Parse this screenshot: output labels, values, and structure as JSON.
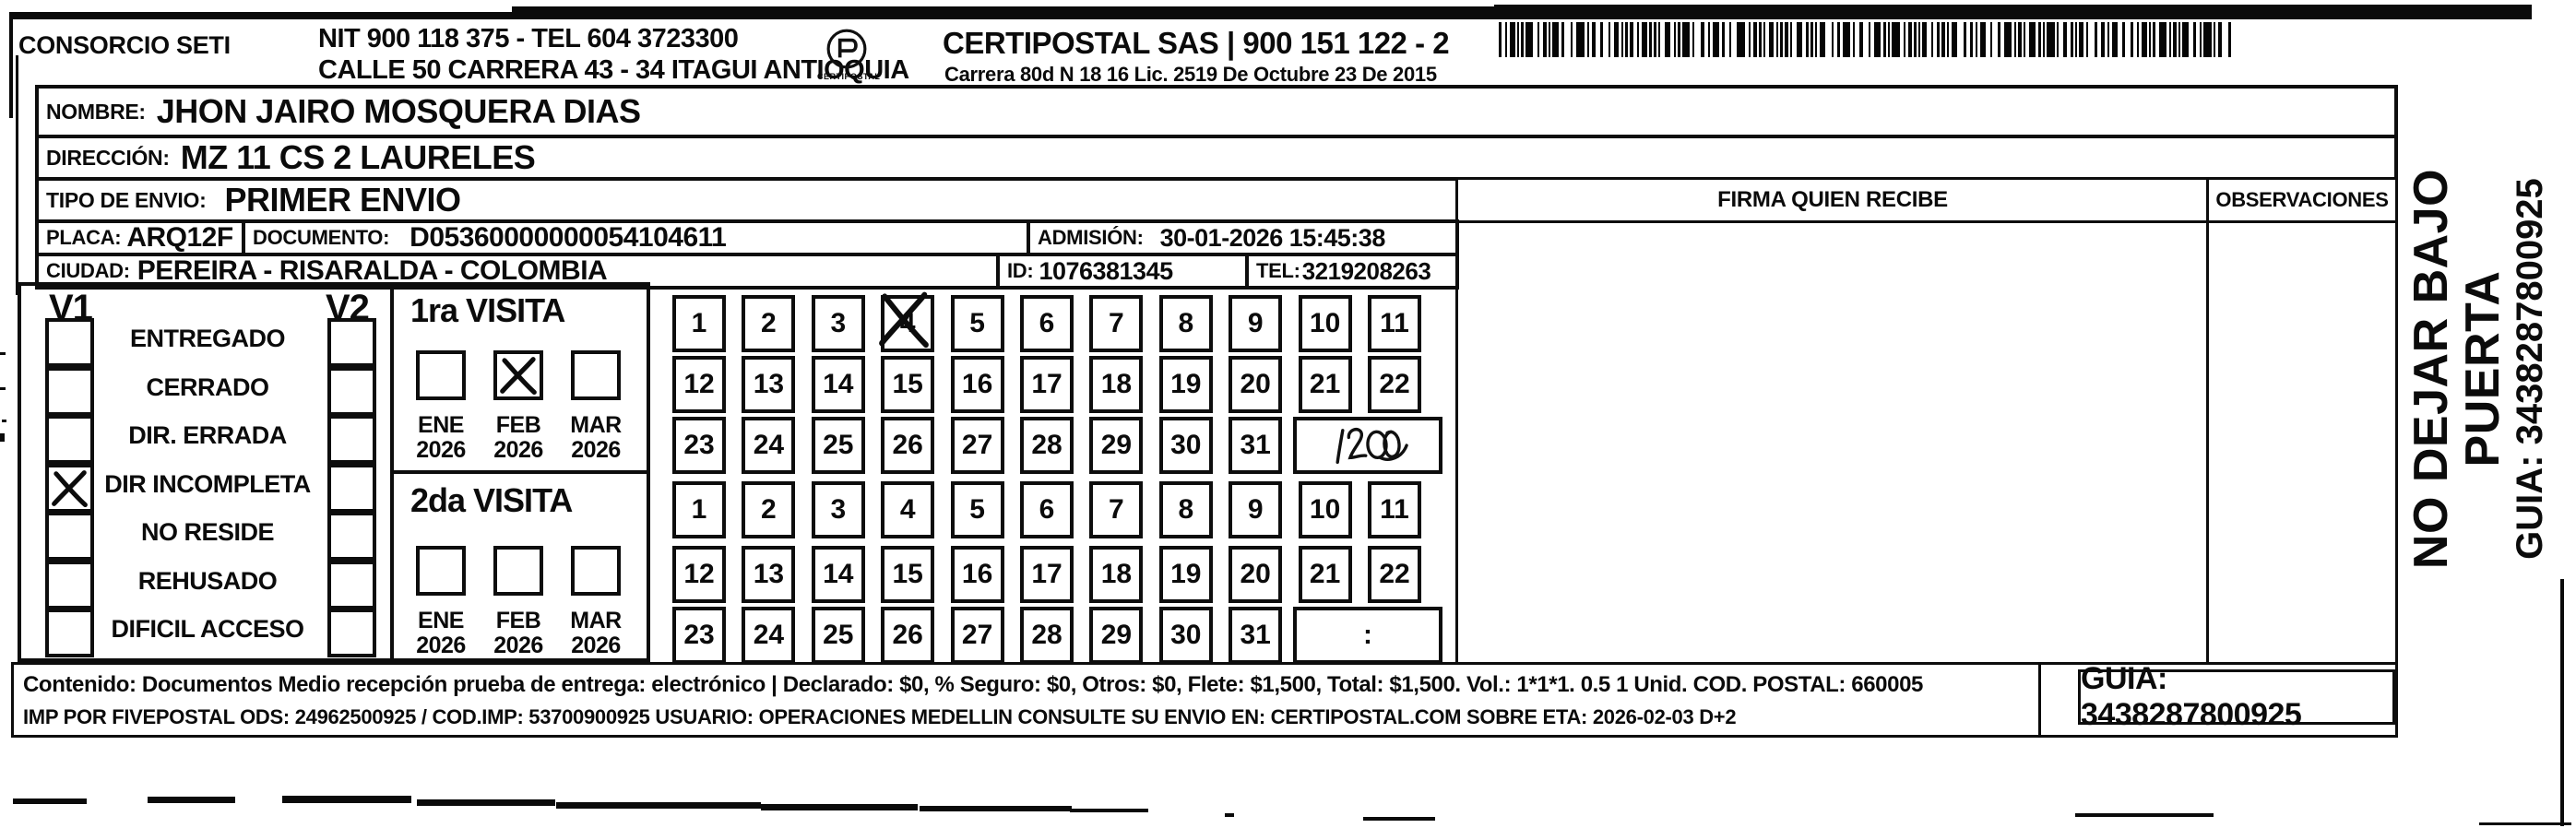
{
  "header": {
    "company": "CONSORCIO SETI",
    "nit_tel": "NIT 900 118 375 - TEL 604 3723300",
    "street": "CALLE 50 CARRERA 43 - 34 ITAGUI ANTIOQUIA",
    "logo_caption": "CERTIPOSTAL",
    "brand_line": "CERTIPOSTAL SAS | 900 151 122 - 2",
    "license_line": "Carrera 80d N 18 16  Lic. 2519 De Octubre 23 De 2015"
  },
  "shipment": {
    "nombre_label": "NOMBRE:",
    "nombre": "JHON JAIRO MOSQUERA DIAS",
    "direccion_label": "DIRECCIÓN:",
    "direccion": "MZ 11 CS 2 LAURELES",
    "tipo_envio_label": "TIPO DE ENVIO:",
    "tipo_envio": "PRIMER ENVIO",
    "placa_label": "PLACA:",
    "placa": "ARQ12F",
    "documento_label": "DOCUMENTO:",
    "documento": "D05360000000054104611",
    "admision_label": "ADMISIÓN:",
    "admision": "30-01-2026 15:45:38",
    "ciudad_label": "CIUDAD:",
    "ciudad": "PEREIRA - RISARALDA - COLOMBIA",
    "id_label": "ID:",
    "id": "1076381345",
    "tel_label": "TEL:",
    "tel": "3219208263"
  },
  "table_headers": {
    "firma": "FIRMA QUIEN RECIBE",
    "observaciones": "OBSERVACIONES"
  },
  "status_panel": {
    "col1": "V1",
    "col2": "V2",
    "items": [
      {
        "label": "ENTREGADO",
        "v1": false,
        "v2": false
      },
      {
        "label": "CERRADO",
        "v1": false,
        "v2": false
      },
      {
        "label": "DIR. ERRADA",
        "v1": false,
        "v2": false
      },
      {
        "label": "DIR INCOMPLETA",
        "v1": true,
        "v2": false
      },
      {
        "label": "NO RESIDE",
        "v1": false,
        "v2": false
      },
      {
        "label": "REHUSADO",
        "v1": false,
        "v2": false
      },
      {
        "label": "DIFICIL ACCESO",
        "v1": false,
        "v2": false
      }
    ]
  },
  "visits": [
    {
      "title": "1ra VISITA",
      "months": [
        {
          "month": "ENE",
          "year": "2026",
          "checked": false
        },
        {
          "month": "FEB",
          "year": "2026",
          "checked": true
        },
        {
          "month": "MAR",
          "year": "2026",
          "checked": false
        }
      ],
      "day_rows": [
        [
          "1",
          "2",
          "3",
          "4",
          "5",
          "6",
          "7",
          "8",
          "9",
          "10",
          "11"
        ],
        [
          "12",
          "13",
          "14",
          "15",
          "16",
          "17",
          "18",
          "19",
          "20",
          "21",
          "22"
        ],
        [
          "23",
          "24",
          "25",
          "26",
          "27",
          "28",
          "29",
          "30",
          "31"
        ]
      ],
      "crossed_day": "4",
      "time_note": "1200"
    },
    {
      "title": "2da VISITA",
      "months": [
        {
          "month": "ENE",
          "year": "2026",
          "checked": false
        },
        {
          "month": "FEB",
          "year": "2026",
          "checked": false
        },
        {
          "month": "MAR",
          "year": "2026",
          "checked": false
        }
      ],
      "day_rows": [
        [
          "1",
          "2",
          "3",
          "4",
          "5",
          "6",
          "7",
          "8",
          "9",
          "10",
          "11"
        ],
        [
          "12",
          "13",
          "14",
          "15",
          "16",
          "17",
          "18",
          "19",
          "20",
          "21",
          "22"
        ],
        [
          "23",
          "24",
          "25",
          "26",
          "27",
          "28",
          "29",
          "30",
          "31"
        ]
      ],
      "crossed_day": null,
      "time_note": ":"
    }
  ],
  "footer": {
    "line1": "Contenido: Documentos Medio recepción prueba de entrega: electrónico | Declarado: $0, % Seguro: $0, Otros: $0, Flete: $1,500, Total: $1,500. Vol.: 1*1*1. 0.5  1 Unid. COD. POSTAL: 660005",
    "line2": "IMP POR FIVEPOSTAL ODS: 24962500925 / COD.IMP: 53700900925 USUARIO: OPERACIONES MEDELLIN CONSULTE SU ENVIO EN: CERTIPOSTAL.COM SOBRE ETA: 2026-02-03 D+2",
    "guia_box": "GUIA: 3438287800925"
  },
  "side_panel": {
    "warning": "NO DEJAR BAJO PUERTA",
    "guia": "GUIA: 3438287800925"
  }
}
